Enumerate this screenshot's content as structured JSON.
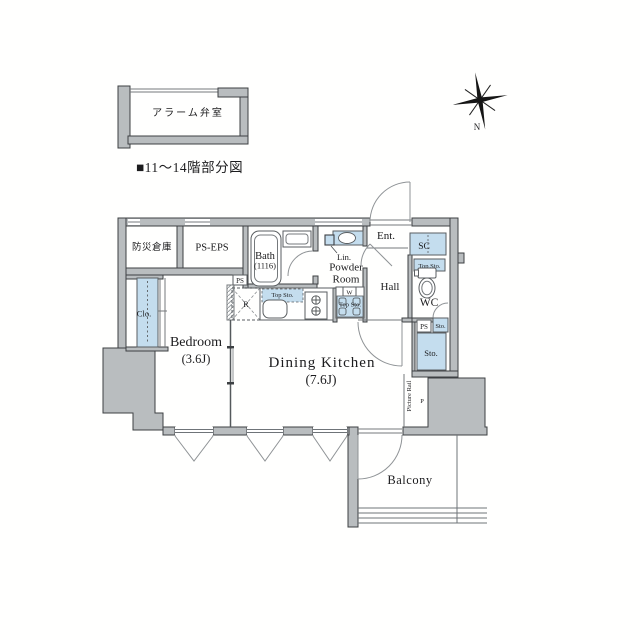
{
  "meta": {
    "title": "■11〜14階部分図"
  },
  "inset": {
    "label": "アラーム弁室"
  },
  "compass": {
    "n": "N"
  },
  "plan": {
    "bousai": "防災倉庫",
    "ps_eps": "PS-EPS",
    "bath": "Bath",
    "bath_size": "(1116)",
    "ps_top": "PS",
    "top_sto_kitchen": "Top Sto.",
    "r": "R",
    "w": "W",
    "top_sto_washer": "Top Sto.",
    "lin": "Lin.",
    "powder1": "Powder",
    "powder2": "Room",
    "ent": "Ent.",
    "hall": "Hall",
    "sc": "SC",
    "top_sto_wc": "Top Sto.",
    "wc": "WC",
    "ps_right": "PS",
    "sto_small": "Sto.",
    "sto_big": "Sto.",
    "clo": "Clo.",
    "bedroom": "Bedroom",
    "bedroom_size": "(3.6J)",
    "dk": "Dining Kitchen",
    "dk_size": "(7.6J)",
    "picture_rail": "Picture Rail",
    "p": "P",
    "balcony": "Balcony"
  },
  "colors": {
    "wall_fill": "#b9bdbf",
    "wall_stroke": "#3d4043",
    "fixture_blue": "#c4ddee",
    "background": "#fffffe",
    "text": "#1c1c1e"
  }
}
